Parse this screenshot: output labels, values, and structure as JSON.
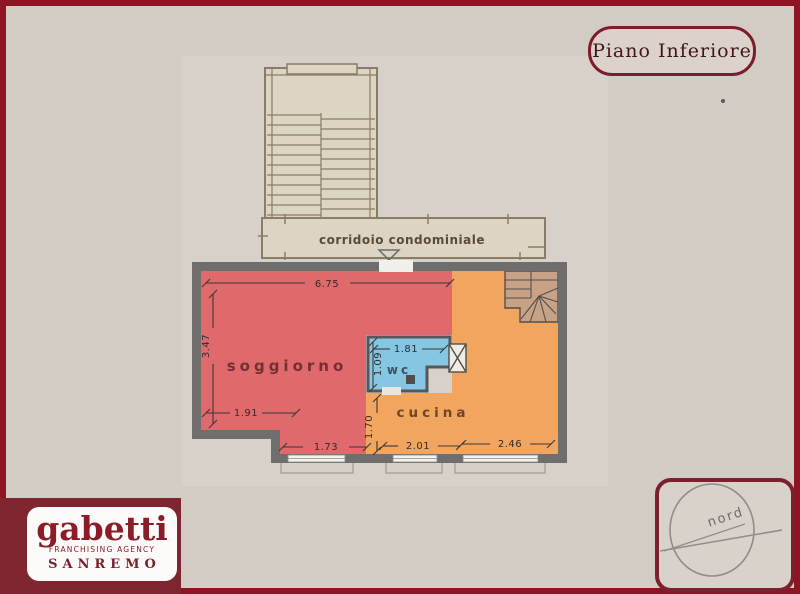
{
  "page": {
    "background_color": "#d3ccc4",
    "border_color": "#8e1424",
    "wall_color": "#6f6e6c"
  },
  "header": {
    "floor_label": "Piano Inferiore"
  },
  "plan": {
    "corridor": {
      "label": "corridoio condominiale"
    },
    "rooms": {
      "soggiorno": {
        "label": "soggiorno",
        "color": "#e0696c"
      },
      "cucina": {
        "label": "cucina",
        "color": "#f2a55e"
      },
      "wc": {
        "label": "wc",
        "color": "#85c6e2"
      }
    },
    "dimensions": {
      "soggiorno_width": "6.75",
      "soggiorno_height": "3.47",
      "soggiorno_inner_width": "1.91",
      "soggiorno_bottom_width": "1.73",
      "cucina_bottom_left_width": "2.01",
      "cucina_bottom_right_width": "2.46",
      "cucina_left_height": "1.70",
      "wc_width": "1.81",
      "wc_height": "1.09"
    }
  },
  "logo": {
    "brand": "gabetti",
    "tagline": "FRANCHISING AGENCY",
    "city": "SANREMO",
    "background_color": "#7f2530",
    "text_color": "#8c1c28"
  },
  "compass": {
    "label": "nord"
  }
}
